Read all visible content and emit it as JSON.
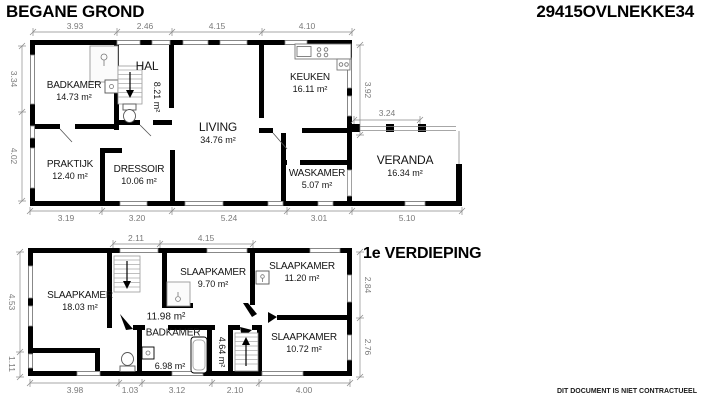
{
  "header": {
    "plan_title": "BEGANE GROND",
    "reference": "29415OVLNEKKE34"
  },
  "first_floor_title": "1e VERDIEPING",
  "disclaimer": "DIT DOCUMENT IS NIET CONTRACTUEEL",
  "colors": {
    "wall": "#000000",
    "dimension": "#7a7a7a",
    "fixture": "#8a8a8a"
  },
  "ground": {
    "rooms": {
      "badkamer": {
        "name": "BADKAMER",
        "area": "14.73 m²"
      },
      "hal": {
        "name": "HAL",
        "area": "8.21 m²"
      },
      "keuken": {
        "name": "KEUKEN",
        "area": "16.11 m²"
      },
      "living": {
        "name": "LIVING",
        "area": "34.76 m²"
      },
      "praktijk": {
        "name": "PRAKTIJK",
        "area": "12.40 m²"
      },
      "dressoir": {
        "name": "DRESSOIR",
        "area": "10.06 m²"
      },
      "waskamer": {
        "name": "WASKAMER",
        "area": "5.07 m²"
      },
      "veranda": {
        "name": "VERANDA",
        "area": "16.34 m²"
      }
    },
    "dims": {
      "top": [
        "3.93",
        "2.46",
        "4.15",
        "4.10"
      ],
      "bottom": [
        "3.19",
        "3.20",
        "5.24",
        "3.01",
        "5.10"
      ],
      "left": [
        "3.34",
        "4.02"
      ],
      "right": [
        "3.92"
      ],
      "veranda": [
        "3.24"
      ]
    }
  },
  "first": {
    "rooms": {
      "slaapkamer_left": {
        "name": "SLAAPKAMER",
        "area": "18.03 m²"
      },
      "slaapkamer_mid": {
        "name": "SLAAPKAMER",
        "area": "9.70 m²"
      },
      "slaapkamer_right": {
        "name": "SLAAPKAMER",
        "area": "11.20 m²"
      },
      "landing": {
        "area": "11.98 m²"
      },
      "badkamer": {
        "name": "BADKAMER",
        "area": "6.98 m²"
      },
      "hall": {
        "area": "4.64 m²"
      },
      "slaapkamer_bottom": {
        "name": "SLAAPKAMER",
        "area": "10.72 m²"
      }
    },
    "dims": {
      "top": [
        "2.11",
        "4.15"
      ],
      "bottom": [
        "3.98",
        "1.03",
        "3.12",
        "2.10",
        "4.00"
      ],
      "left": [
        "4.53",
        "1.11"
      ],
      "right": [
        "2.84",
        "2.76"
      ]
    }
  }
}
